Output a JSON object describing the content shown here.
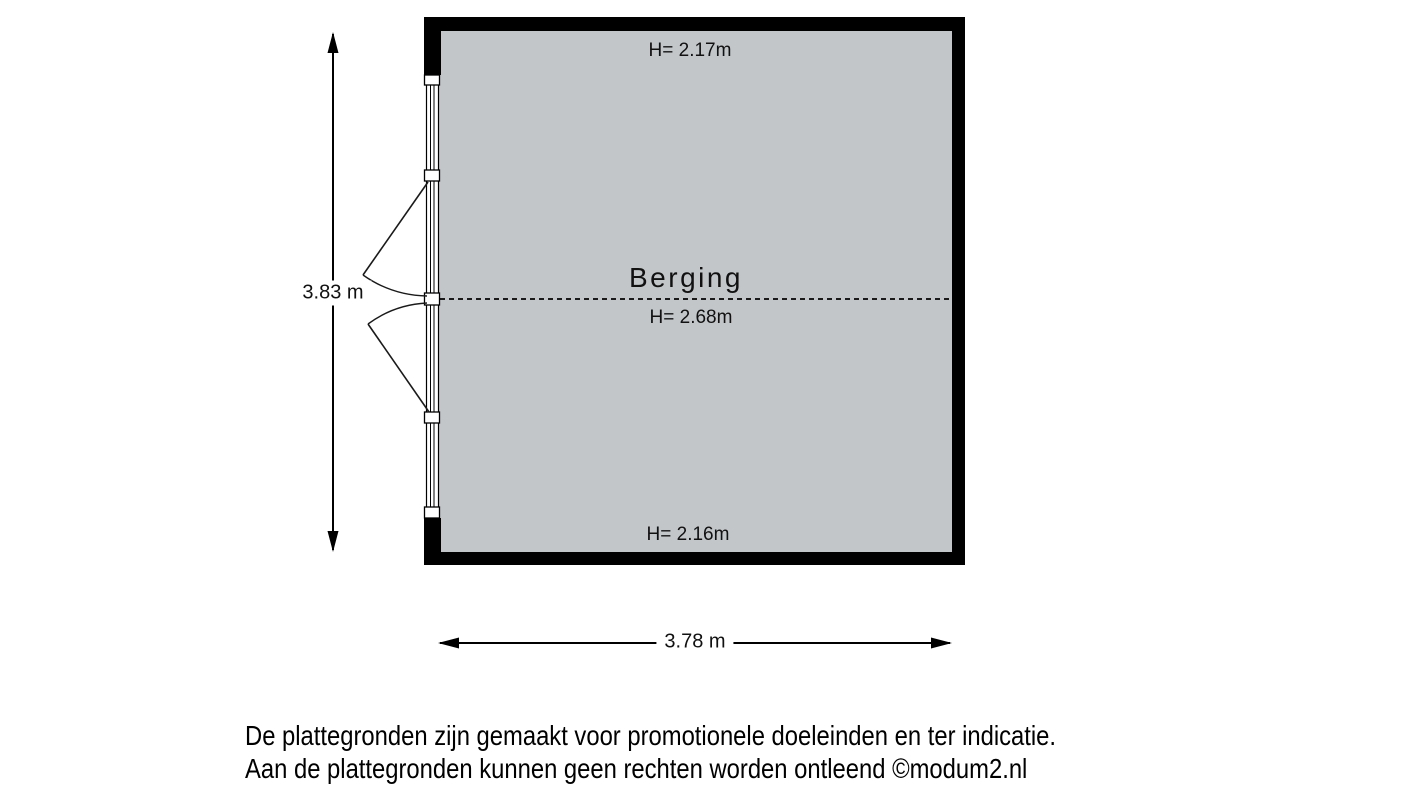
{
  "floorplan": {
    "room": {
      "name": "Berging",
      "height_top": "H= 2.17m",
      "height_middle": "H= 2.68m",
      "height_bottom": "H= 2.16m"
    },
    "dimensions": {
      "height_label": "3.83 m",
      "width_label": "3.78 m"
    },
    "features": {
      "left_wall": "double glazed doors with two outward swinging leaves and window frames",
      "divider": "dashed ceiling-height division line"
    },
    "colors": {
      "wall": "#000000",
      "floor": "#c2c6c9",
      "background": "#ffffff",
      "line": "#1a1a1a"
    }
  },
  "footer": {
    "line1": "De plattegronden zijn gemaakt voor promotionele doeleinden en ter indicatie.",
    "line2": "Aan de plattegronden kunnen geen rechten worden ontleend ©modum2.nl"
  }
}
